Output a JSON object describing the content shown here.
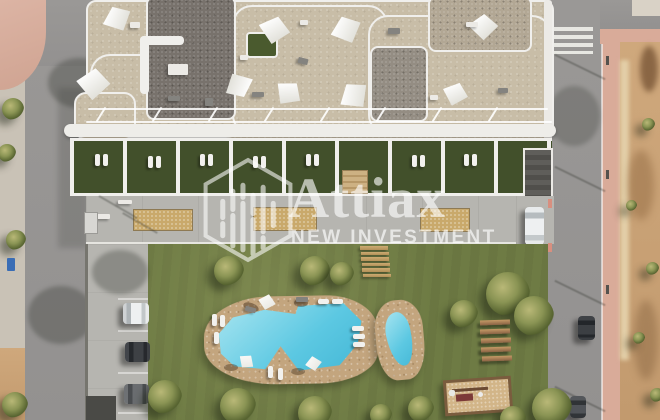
{
  "meta": {
    "canvas_width": 660,
    "canvas_height": 420,
    "view": "aerial top-down architectural render of residential complex"
  },
  "watermark": {
    "brand": "Attiax",
    "tagline": "NEW INVESTMENT",
    "logo_icon": "hexagon-skyline-logo",
    "text_color": "#ffffff",
    "opacity": 0.62
  },
  "palette": {
    "road": "#9a9896",
    "paleWalk": "#c9c2b6",
    "pinkWalk": "#d9ab99",
    "sand": "#cfa87c",
    "lawn": "#6e7b44",
    "terraceGrass": "#42502b",
    "roofBeige": "#c8bda7",
    "roofGravel": "#78726c",
    "white": "#f0efec",
    "concrete": "#b6b5b0",
    "deck": "#c3a57e",
    "water": "#5cc8e2",
    "waterLight": "#9be0ee",
    "planter": "#c9a96b"
  },
  "scene": {
    "legend": [
      "apartment-building-rooftop-terraces",
      "shade-sails",
      "private-ground-floor-terraces",
      "communal-walkway-with-planters",
      "communal-garden-lawn",
      "main-swimming-pool",
      "kids-pool",
      "sun-loungers-and-umbrellas",
      "parking-area-with-cars",
      "left-street",
      "right-street-with-crosswalk",
      "pink-sidewalks",
      "undeveloped-sandy-plot",
      "garden-benches",
      "wood-plank-path",
      "playground"
    ]
  }
}
